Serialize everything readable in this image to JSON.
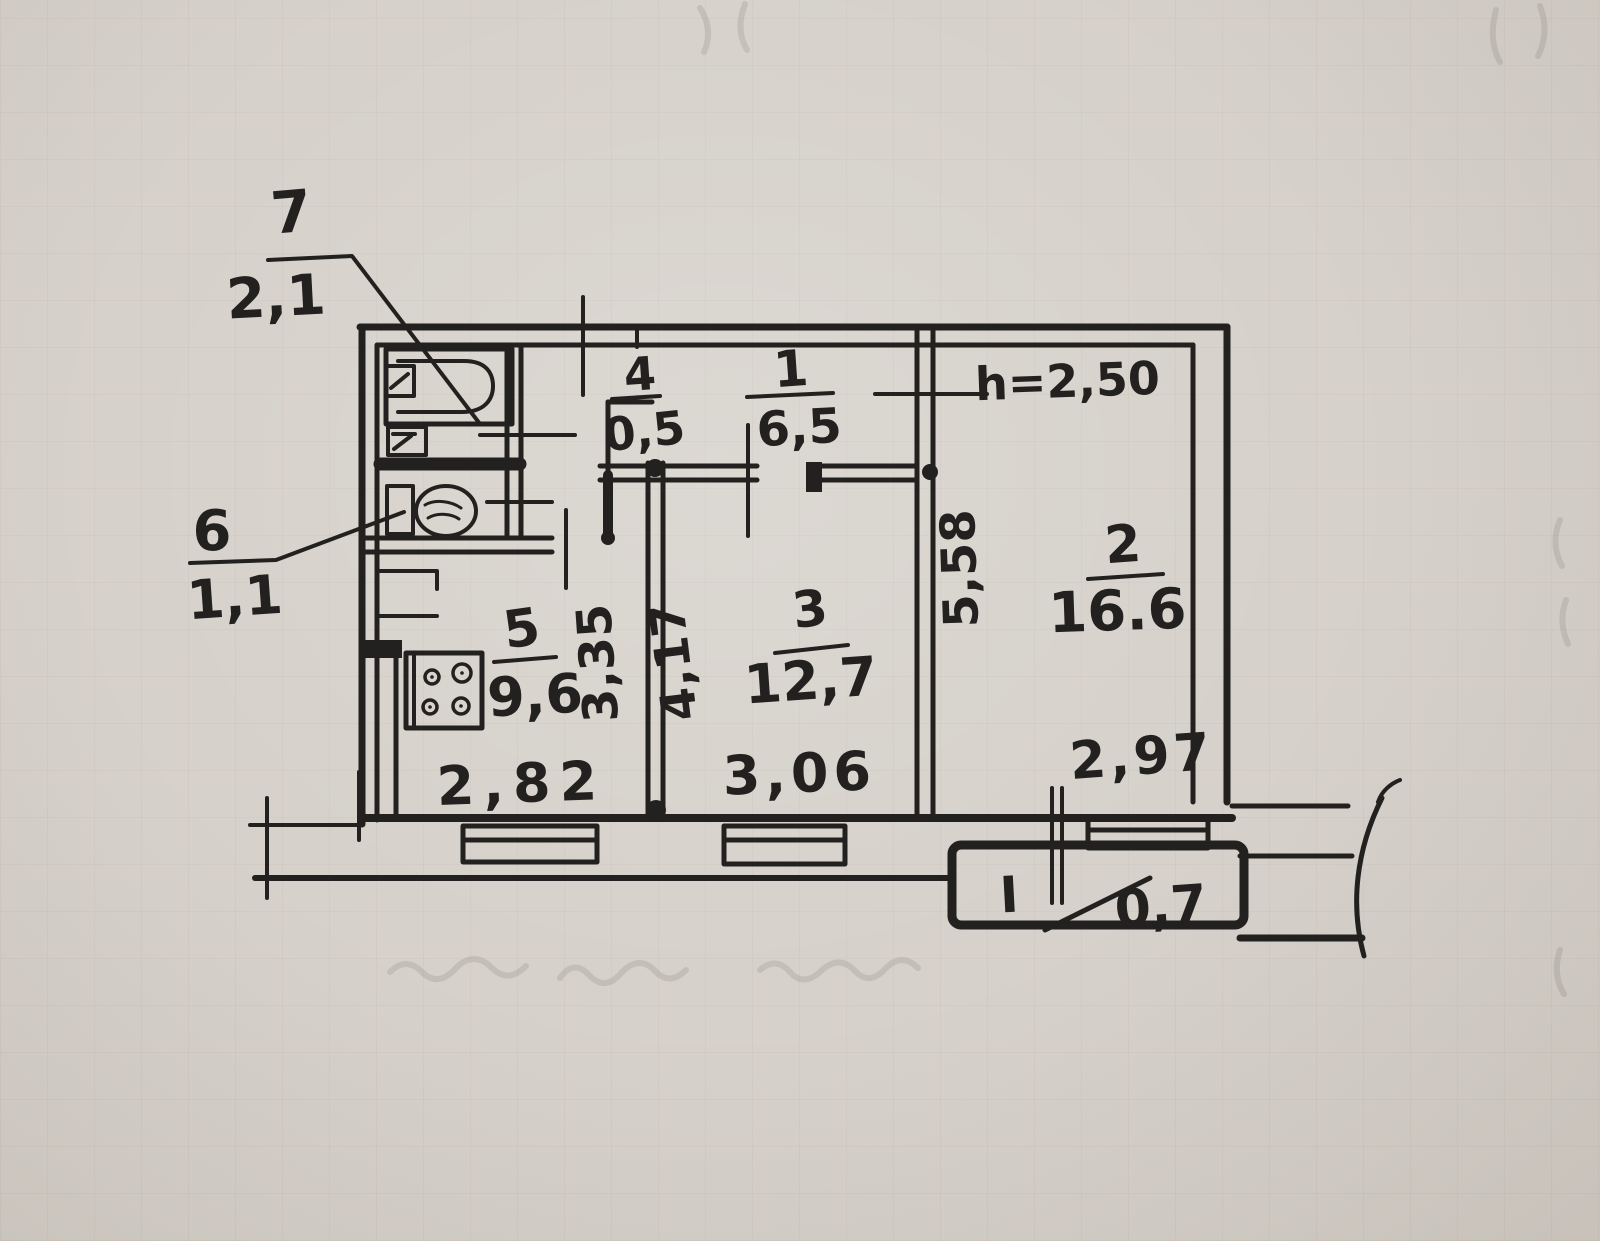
{
  "document": {
    "kind": "hand-drawn apartment floor plan",
    "ink_color": "#23211f",
    "paper_color": "#d3cec7"
  },
  "plan": {
    "height_note": "h=2,50",
    "labels": {
      "room7": {
        "num": "7",
        "area": "2,1",
        "name": "bathroom"
      },
      "room6": {
        "num": "6",
        "area": "1,1",
        "name": "wc"
      },
      "room5": {
        "num": "5",
        "area": "9,6",
        "name": "kitchen"
      },
      "room4": {
        "num": "4",
        "area": "0,5",
        "name": "closet"
      },
      "room1": {
        "num": "1",
        "area": "6,5",
        "name": "hallway"
      },
      "room3": {
        "num": "3",
        "area": "12,7",
        "name": "room"
      },
      "room2": {
        "num": "2",
        "area": "16.6",
        "name": "room"
      },
      "balcony": {
        "num": "I",
        "area": "0,7",
        "name": "balcony"
      }
    },
    "dims": {
      "kitchen_width": "2,82",
      "room3_width": "3,06",
      "room2_width": "2,97",
      "kitchen_depth": "3,35",
      "room3_depth": "4,17",
      "room2_depth": "5,58"
    }
  }
}
